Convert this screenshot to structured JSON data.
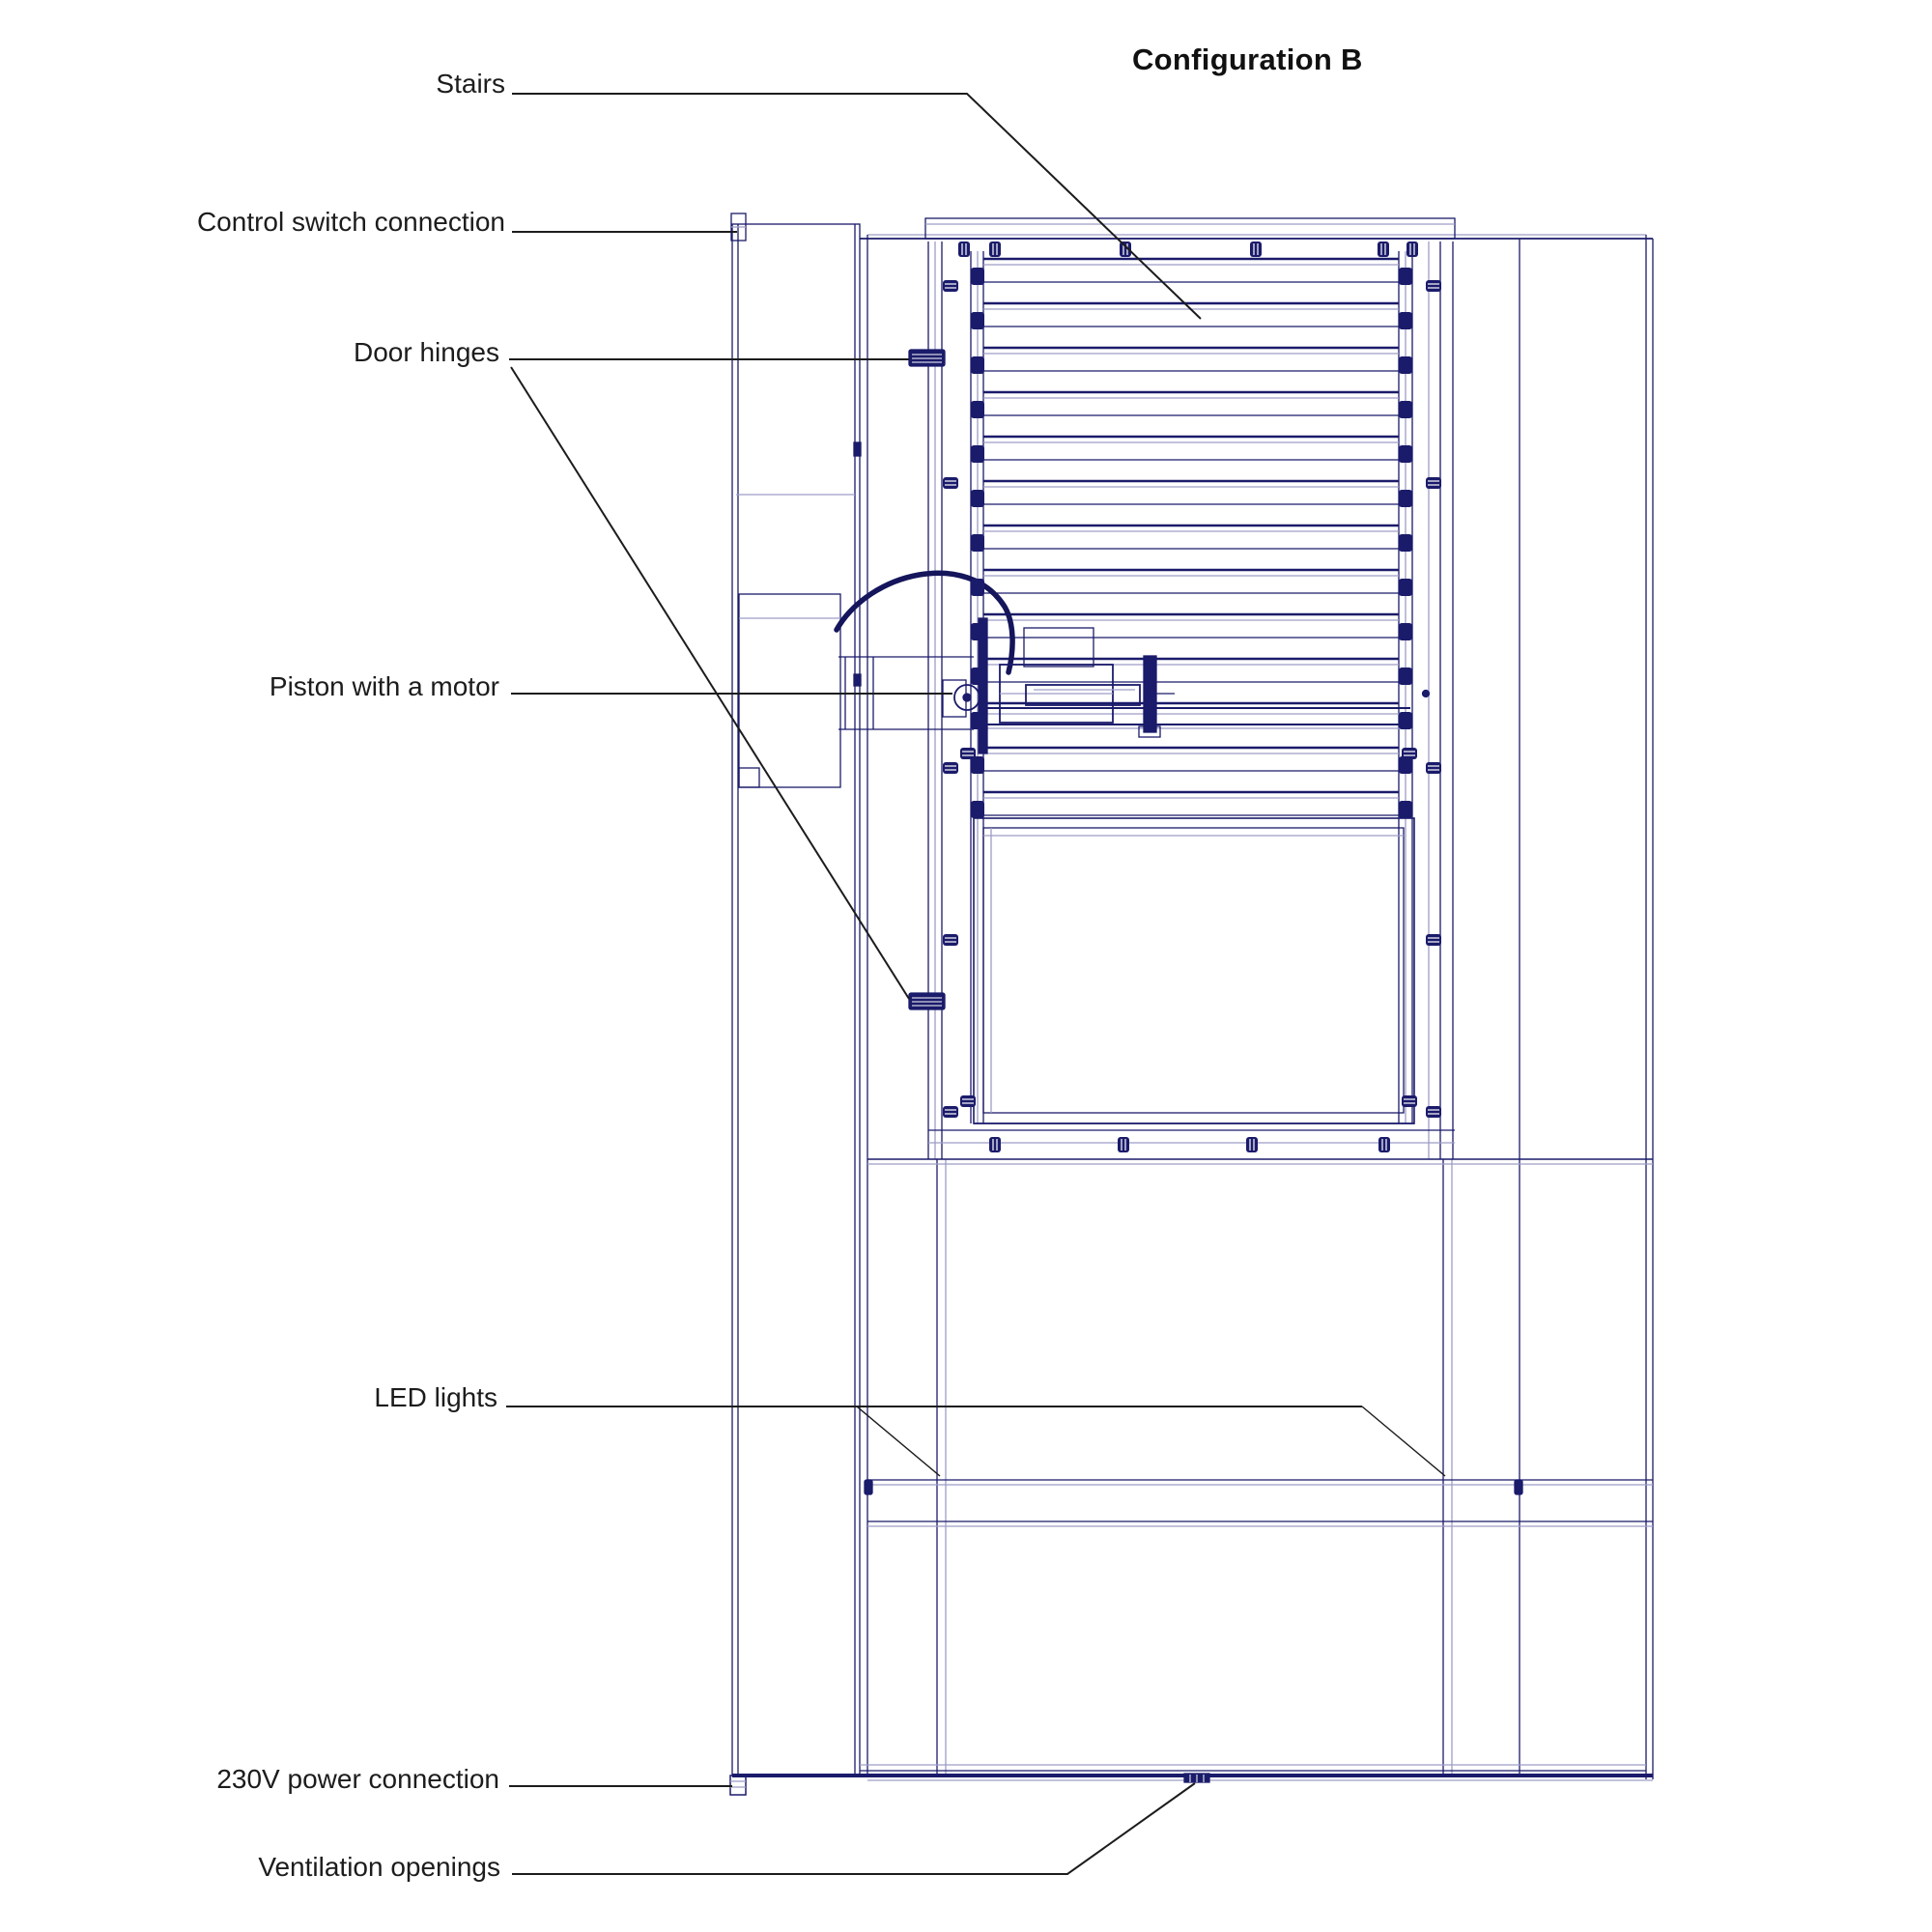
{
  "page": {
    "title": "Configuration B"
  },
  "colors": {
    "line_navy": "#1b1b6b",
    "line_navy_dark": "#15155c",
    "line_light": "#9d9dc7",
    "label_black": "#1c1c1c",
    "background": "#ffffff"
  },
  "labels": {
    "stairs": "Stairs",
    "control_switch": "Control switch connection",
    "door_hinges": "Door hinges",
    "piston": "Piston with a motor",
    "led": "LED lights",
    "power": "230V power connection",
    "ventilation": "Ventilation openings"
  }
}
